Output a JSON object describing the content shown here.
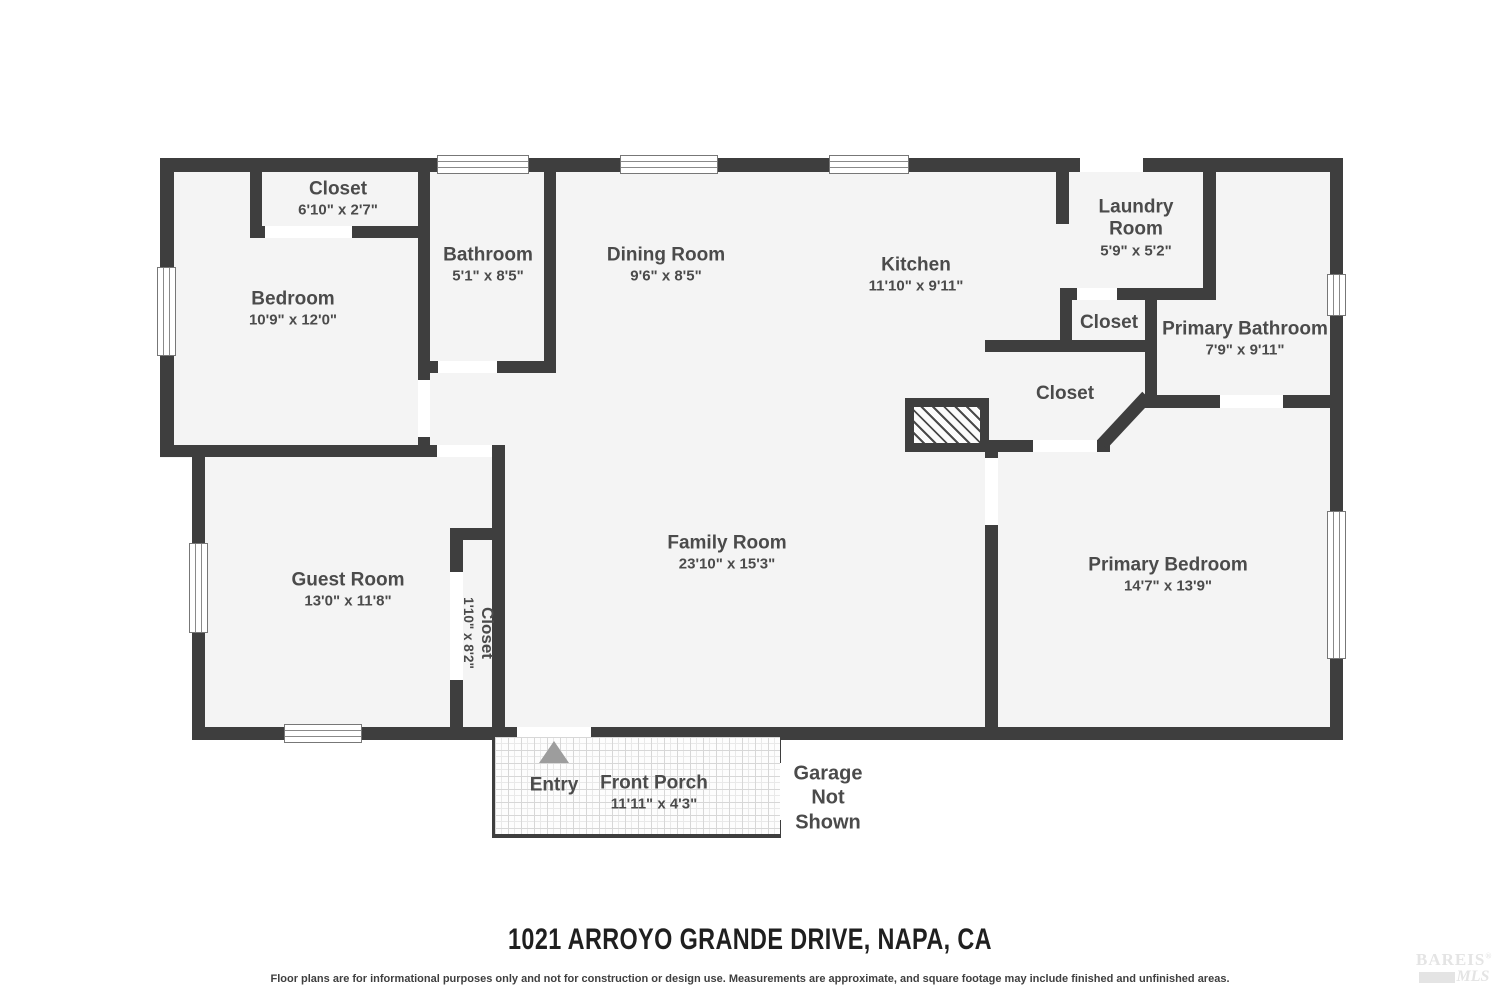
{
  "title": "1021 ARROYO GRANDE DRIVE, NAPA, CA",
  "disclaimer": "Floor plans are for informational purposes only and not for construction or design use. Measurements are approximate, and square footage may include finished and unfinished areas.",
  "logo": {
    "name": "BAREIS",
    "reg": "®",
    "sub": "MLS"
  },
  "colors": {
    "wall": "#3e3e3e",
    "floor": "#f4f4f4",
    "label": "#4b4b4b",
    "entry_arrow": "#9d9d9d"
  },
  "rooms": [
    {
      "id": "closet-top-left",
      "name": "Closet",
      "dims": "6'10\" x 2'7\""
    },
    {
      "id": "bedroom",
      "name": "Bedroom",
      "dims": "10'9\" x 12'0\""
    },
    {
      "id": "bathroom",
      "name": "Bathroom",
      "dims": "5'1\" x 8'5\""
    },
    {
      "id": "dining-room",
      "name": "Dining Room",
      "dims": "9'6\" x 8'5\""
    },
    {
      "id": "kitchen",
      "name": "Kitchen",
      "dims": "11'10\" x 9'11\""
    },
    {
      "id": "laundry-room",
      "name": "Laundry Room",
      "dims": "5'9\" x 5'2\""
    },
    {
      "id": "closet-laundry",
      "name": "Closet",
      "dims": ""
    },
    {
      "id": "primary-bathroom",
      "name": "Primary Bathroom",
      "dims": "7'9\" x 9'11\""
    },
    {
      "id": "closet-hall",
      "name": "Closet",
      "dims": ""
    },
    {
      "id": "guest-room",
      "name": "Guest Room",
      "dims": "13'0\" x 11'8\""
    },
    {
      "id": "closet-guest",
      "name": "Closet",
      "dims": "1'10\" x 8'2\""
    },
    {
      "id": "family-room",
      "name": "Family Room",
      "dims": "23'10\" x 15'3\""
    },
    {
      "id": "primary-bedroom",
      "name": "Primary Bedroom",
      "dims": "14'7\" x 13'9\""
    },
    {
      "id": "front-porch",
      "name": "Front Porch",
      "dims": "11'11\" x 4'3\""
    }
  ],
  "annotations": {
    "entry": "Entry",
    "garage": "Garage Not Shown"
  }
}
